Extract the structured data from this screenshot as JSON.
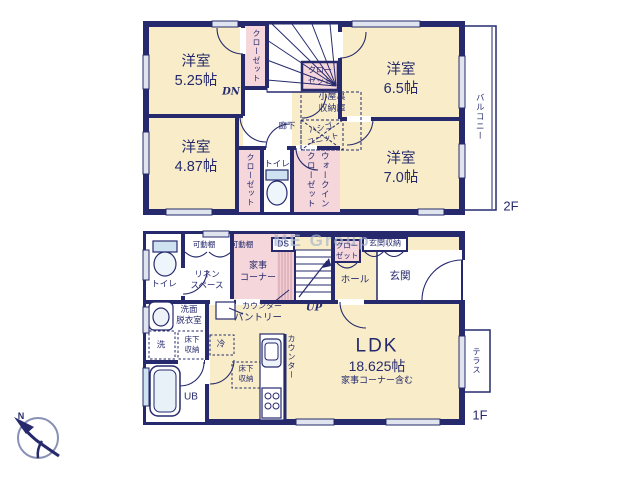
{
  "watermark": "ME Group",
  "compass": {
    "north": "N"
  },
  "floor_2f": {
    "floor_label": "2F",
    "room_525": "洋室\n5.25帖",
    "room_65": "洋室\n6.5帖",
    "room_487": "洋室\n4.87帖",
    "room_70": "洋室\n7.0帖",
    "closet_525": "クローゼット",
    "closet_hall": "クロー\nゼット",
    "closet_487": "クローゼット",
    "wic_line1": "ウォークイン",
    "wic_line2": "クローゼット",
    "attic": "小屋裏\n収納庫",
    "ladder_unit": "ハシゴ\nユニット",
    "hallway": "廊下",
    "toilet": "トイレ",
    "down": "DN",
    "balcony": "バルコニー"
  },
  "floor_1f": {
    "floor_label": "1F",
    "toilet": "トイレ",
    "shelf_1": "可動棚",
    "shelf_2": "可動棚",
    "linen": "リネン\nスペース",
    "housework_corner": "家事\nコーナー",
    "duct_space": "DS",
    "closet": "クロー\nゼット",
    "entry_storage": "玄関収納",
    "hall": "ホール",
    "entrance": "玄関",
    "up": "UP",
    "counter_housework": "カウンター",
    "pantry": "パントリー",
    "washroom": "洗面\n脱衣室",
    "washer": "洗",
    "underfloor_storage_1": "床下\n収納",
    "fridge": "冷",
    "underfloor_storage_2": "床下\n収納",
    "counter_kitchen": "カウンター",
    "unit_bath": "UB",
    "ldk_name": "LDK",
    "ldk_size": "18.625帖",
    "ldk_note": "家事コーナー含む",
    "terrace": "テラス"
  }
}
